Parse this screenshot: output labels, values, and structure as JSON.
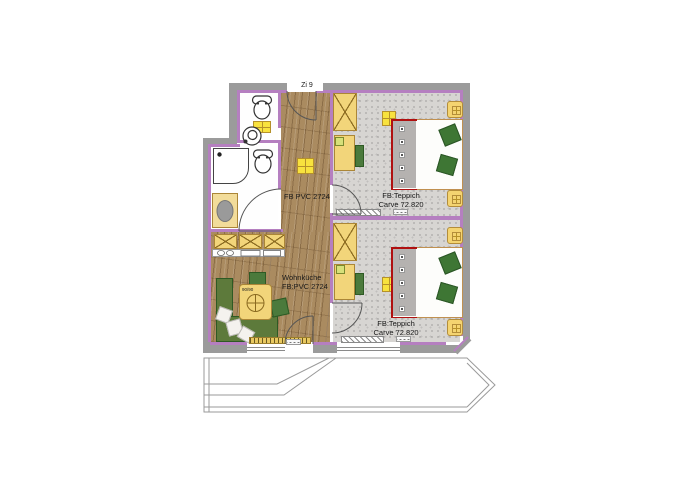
{
  "title": {
    "room_number": "Zi 9"
  },
  "labels": {
    "hall_floor": "FB PVC 2724",
    "kitchen_name": "Wohnküche",
    "kitchen_floor": "FB:PVC 2724",
    "bedroom1_floor_1": "FB:Teppich",
    "bedroom1_floor_2": "Carve 72.820",
    "bedroom2_floor_1": "FB:Teppich",
    "bedroom2_floor_2": "Carve 72.820",
    "table_size": "90/90"
  },
  "colors": {
    "wall_line": "#b57fc0",
    "wall_fill": "#9b9b9b",
    "wood_floor": "#aa8b60",
    "carpet_floor": "#d7d5d2",
    "furniture_yellow": "#f2d57a",
    "light_yellow": "#f8e23e",
    "pillow_green": "#3e7634",
    "bench_green": "#5d7a3b",
    "bed_accent_red": "#b01010"
  },
  "icons": [
    "toilet-icon",
    "toilet-icon",
    "sink-icon",
    "shower-icon",
    "washing-machine-icon",
    "kitchen-cabinet-icon",
    "dining-table-icon",
    "bed-icon",
    "bed-icon",
    "wardrobe-icon",
    "wardrobe-icon",
    "ceiling-light-icon",
    "door-swing-arc",
    "balcony-outline"
  ]
}
